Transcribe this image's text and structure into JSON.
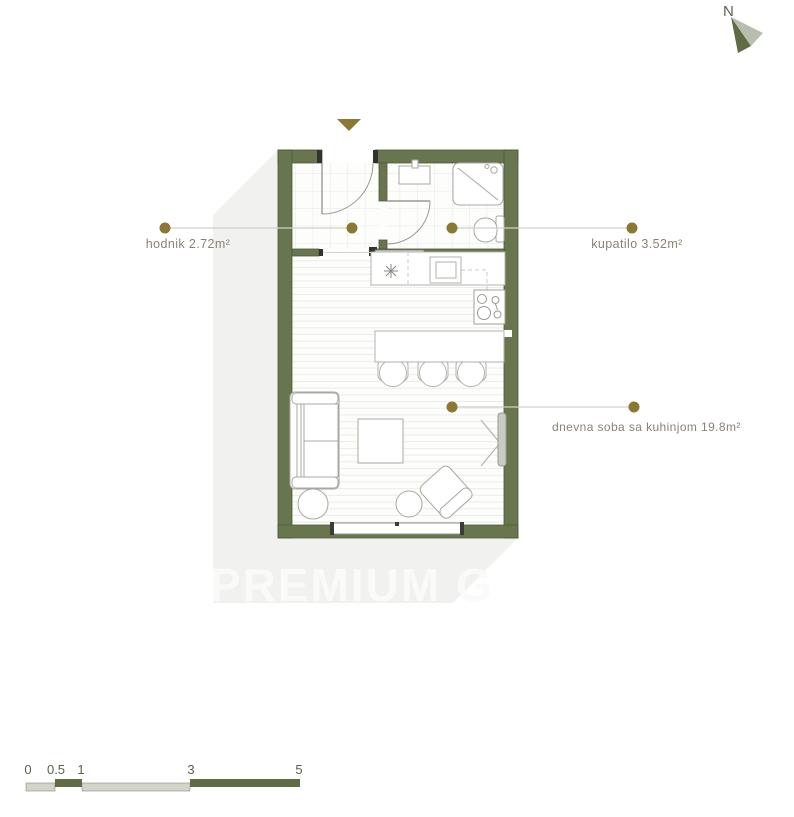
{
  "north": {
    "label": "N"
  },
  "entry": {
    "marker": "triangle-down-icon"
  },
  "rooms": [
    {
      "name": "hodnik",
      "label": "hodnik 2.72m²"
    },
    {
      "name": "kupatilo",
      "label": "kupatilo 3.52m²"
    },
    {
      "name": "dnevna-soba",
      "label": "dnevna soba sa kuhinjom 19.8m²"
    }
  ],
  "watermark": "PREMIUM G",
  "scale": {
    "ticks": [
      "0",
      "0.5",
      "1",
      "3",
      "5"
    ]
  },
  "colors": {
    "wall": "#68754e",
    "accent_dot": "#8c7833",
    "label_text": "#8b8275",
    "shadow_band": "#f1f1ef",
    "scale_light": "#d2d4ca",
    "scale_dark": "#5e6b43"
  }
}
